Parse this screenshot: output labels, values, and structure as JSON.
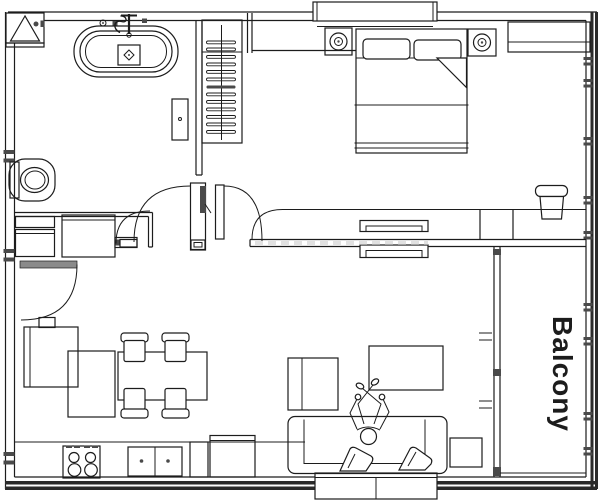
{
  "canvas": {
    "width": 602,
    "height": 500
  },
  "palette": {
    "background": "#ffffff",
    "line": "#1c1c1c",
    "wall": "#2b2b2b",
    "leaf": "#8a8a8a",
    "leaf_dark": "#4a4a4a",
    "watermark": "#c9c9c9"
  },
  "labels": {
    "balcony": "Balcony"
  },
  "fixtures": [
    "duct-shaft",
    "bathtub",
    "tub-faucet",
    "wall-shelf",
    "toilet",
    "vanity-cabinets",
    "washing-machine",
    "wardrobe-with-hangers",
    "double-swing-doors",
    "laundry-door",
    "entry-door",
    "refrigerator",
    "kitchen-counter",
    "stove",
    "kitchen-sink",
    "kitchen-cabinets",
    "dining-table",
    "dining-chairs",
    "sideboard",
    "sofa",
    "chaise-lounge",
    "sofa-pillows",
    "person-lying",
    "coffee-table",
    "side-table",
    "bed",
    "bed-pillows",
    "folded-blanket",
    "ceiling-speakers",
    "dresser",
    "desk",
    "desk-chair",
    "sliding-door-panels",
    "balcony-partition",
    "bay-window-top",
    "bay-window-bottom",
    "window-wall"
  ]
}
